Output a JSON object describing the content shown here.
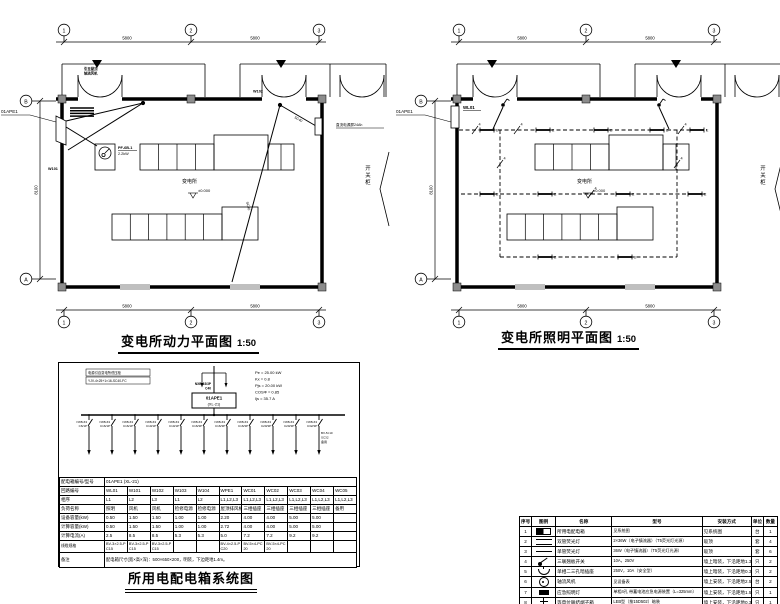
{
  "plans": {
    "grid_bubbles": [
      "1",
      "2",
      "3"
    ],
    "left_bubble_top": "B",
    "left_bubble_bottom": "A",
    "dim_top": [
      "5800",
      "5800"
    ],
    "dim_bottom": [
      "5800",
      "5800"
    ],
    "dim_left": "8100",
    "side_room_label": "开关柜"
  },
  "power_plan": {
    "title": "变电所动力平面图",
    "scale": "1:50",
    "panel_label": "01APE1",
    "room_name": "变电所",
    "level": "±0.000",
    "fan_tag": "PF-6B-1",
    "fan_power": "2.2kW",
    "roof_fan_note_1": "引至屋顶",
    "roof_fan_note_2": "轴流风机",
    "dc_panel_note": "直流电源屏24Ah",
    "wire_labels": {
      "w101": "W101",
      "w102": "W102",
      "sc40": "SC40"
    }
  },
  "lighting_plan": {
    "title": "变电所照明平面图",
    "scale": "1:50",
    "panel_label": "01APE1",
    "circuit": "WL01",
    "room_name": "变电所",
    "level": "±0.000",
    "lamp_mark": "E",
    "wire_count": "4"
  },
  "system": {
    "title": "所用电配电箱系统图",
    "source_note_1": "电源引自变电所低压柜",
    "source_note_2": "YJV-4×25+1×16-SC40-FC",
    "main_breaker_1": "NXB-63/3P",
    "main_breaker_2": "C40",
    "panel_id": "01APE1",
    "panel_model": "(XL-21)",
    "params": [
      "Pe = 25.00 kW",
      "Kx = 0.8",
      "Pjs = 20.00 kW",
      "COSΦ = 0.85",
      "Ijs = 35.7 A"
    ],
    "branches": [
      {
        "breaker": "NXB-63",
        "rating": "C6/1P"
      },
      {
        "breaker": "NXB-63",
        "rating": "C16/1P"
      },
      {
        "breaker": "NXB-63",
        "rating": "C16/1P"
      },
      {
        "breaker": "NXB-63",
        "rating": "C10/1P"
      },
      {
        "breaker": "NXB-63",
        "rating": "C10/1P"
      },
      {
        "breaker": "NXB-63",
        "rating": "C16/3P"
      },
      {
        "breaker": "NXB-63",
        "rating": "C16/3P"
      },
      {
        "breaker": "NXB-63",
        "rating": "C16/3P"
      },
      {
        "breaker": "NXB-63",
        "rating": "C20/3P"
      },
      {
        "breaker": "NXB-63",
        "rating": "C20/3P"
      },
      {
        "breaker": "NXB-63",
        "rating": "C32/3P",
        "note": [
          "BV-5×10",
          "SC32",
          "备用"
        ]
      }
    ],
    "table": {
      "col_count": 11,
      "rows": [
        {
          "label": "配电箱编号/型号",
          "span": "01APE1 (XL-21)"
        },
        {
          "label": "回路编号",
          "cells": [
            "WL01",
            "W101",
            "W102",
            "W103",
            "W104",
            "WPE1",
            "WC01",
            "WC02",
            "WC03",
            "WC04",
            "WC05"
          ]
        },
        {
          "label": "相序",
          "cells": [
            "L1",
            "L2",
            "L3",
            "L1",
            "L2",
            "L1,L2,L3",
            "L1,L2,L3",
            "L1,L2,L3",
            "L1,L2,L3",
            "L1,L2,L3",
            "L1,L2,L3"
          ]
        },
        {
          "label": "负荷名称",
          "cells": [
            "照明",
            "风机",
            "风机",
            "检修电源",
            "检修电源",
            "屋顶排风机",
            "三相插座",
            "三相插座",
            "三相插座",
            "三相插座",
            "备用"
          ]
        },
        {
          "label": "设备容量(kW)",
          "cells": [
            "0.50",
            "1.50",
            "1.50",
            "1.00",
            "1.00",
            "2.20",
            "4.00",
            "4.00",
            "5.00",
            "5.00",
            ""
          ]
        },
        {
          "label": "计算容量(kW)",
          "cells": [
            "0.50",
            "1.50",
            "1.50",
            "1.00",
            "1.00",
            "2.72",
            "4.00",
            "4.00",
            "5.00",
            "5.00",
            ""
          ]
        },
        {
          "label": "计算电流(A)",
          "cells": [
            "2.5",
            "8.5",
            "8.5",
            "5.3",
            "5.3",
            "5.0",
            "7.2",
            "7.2",
            "9.2",
            "9.2",
            ""
          ]
        },
        {
          "label": "线缆规格",
          "cells": [
            "BV-3×2.5-PC15",
            "BV-3×2.5-PC15",
            "BV-3×2.5-PC15",
            "",
            "",
            "BV-4×2.5-PC20",
            "BV-5×4-PC20",
            "BV-5×4-PC20",
            "",
            "",
            ""
          ],
          "wrap": true
        },
        {
          "label": "备注",
          "span": "配电箱尺寸(宽×高×深)：500×650×200，明装，下边距地1.4m。",
          "remark": true
        }
      ]
    }
  },
  "legend": {
    "headers": [
      "序号",
      "图例",
      "名称",
      "型号",
      "安装方式",
      "单位",
      "数量"
    ],
    "rows": [
      {
        "no": "1",
        "symbol": "panel",
        "name": "所用电配电箱",
        "spec": "见系统图",
        "install": "见系统图",
        "unit": "台",
        "qty": "1"
      },
      {
        "no": "2",
        "symbol": "double-lamp",
        "name": "双管荧光灯",
        "spec": "2×36W（电子镇流器）（T5荧光灯光源）",
        "install": "吸顶",
        "unit": "套",
        "qty": "4"
      },
      {
        "no": "3",
        "symbol": "single-lamp",
        "name": "单管荧光灯",
        "spec": "36W（电子镇流器）（T5荧光灯光源）",
        "install": "吸顶",
        "unit": "套",
        "qty": "6"
      },
      {
        "no": "4",
        "symbol": "switch",
        "name": "三联翘板开关",
        "spec": "10A，250V",
        "install": "墙上暗装，下沿距地1.3M",
        "unit": "只",
        "qty": "2"
      },
      {
        "no": "5",
        "symbol": "socket",
        "name": "单相二三孔暗插座",
        "spec": "250V，10A（安全型）",
        "install": "墙上暗装，下沿距地0.3M",
        "unit": "只",
        "qty": "2"
      },
      {
        "no": "6",
        "symbol": "fan",
        "name": "轴流风机",
        "spec": "见设备表",
        "install": "墙上安装，下沿距地2.5M",
        "unit": "台",
        "qty": "2"
      },
      {
        "no": "7",
        "symbol": "emergency-lamp",
        "name": "应急照明灯",
        "spec": "单相4孔 带蓄电池应急电源装置（L=325mm）",
        "install": "墙上安装，下沿距地1.5M",
        "unit": "只",
        "qty": "1"
      },
      {
        "no": "8",
        "symbol": "ground-terminal",
        "name": "等电位联结端子箱",
        "spec": "LEB型（按15D502）暗装",
        "install": "墙上安装，下沿距地0.3M",
        "unit": "只",
        "qty": "1"
      }
    ]
  }
}
